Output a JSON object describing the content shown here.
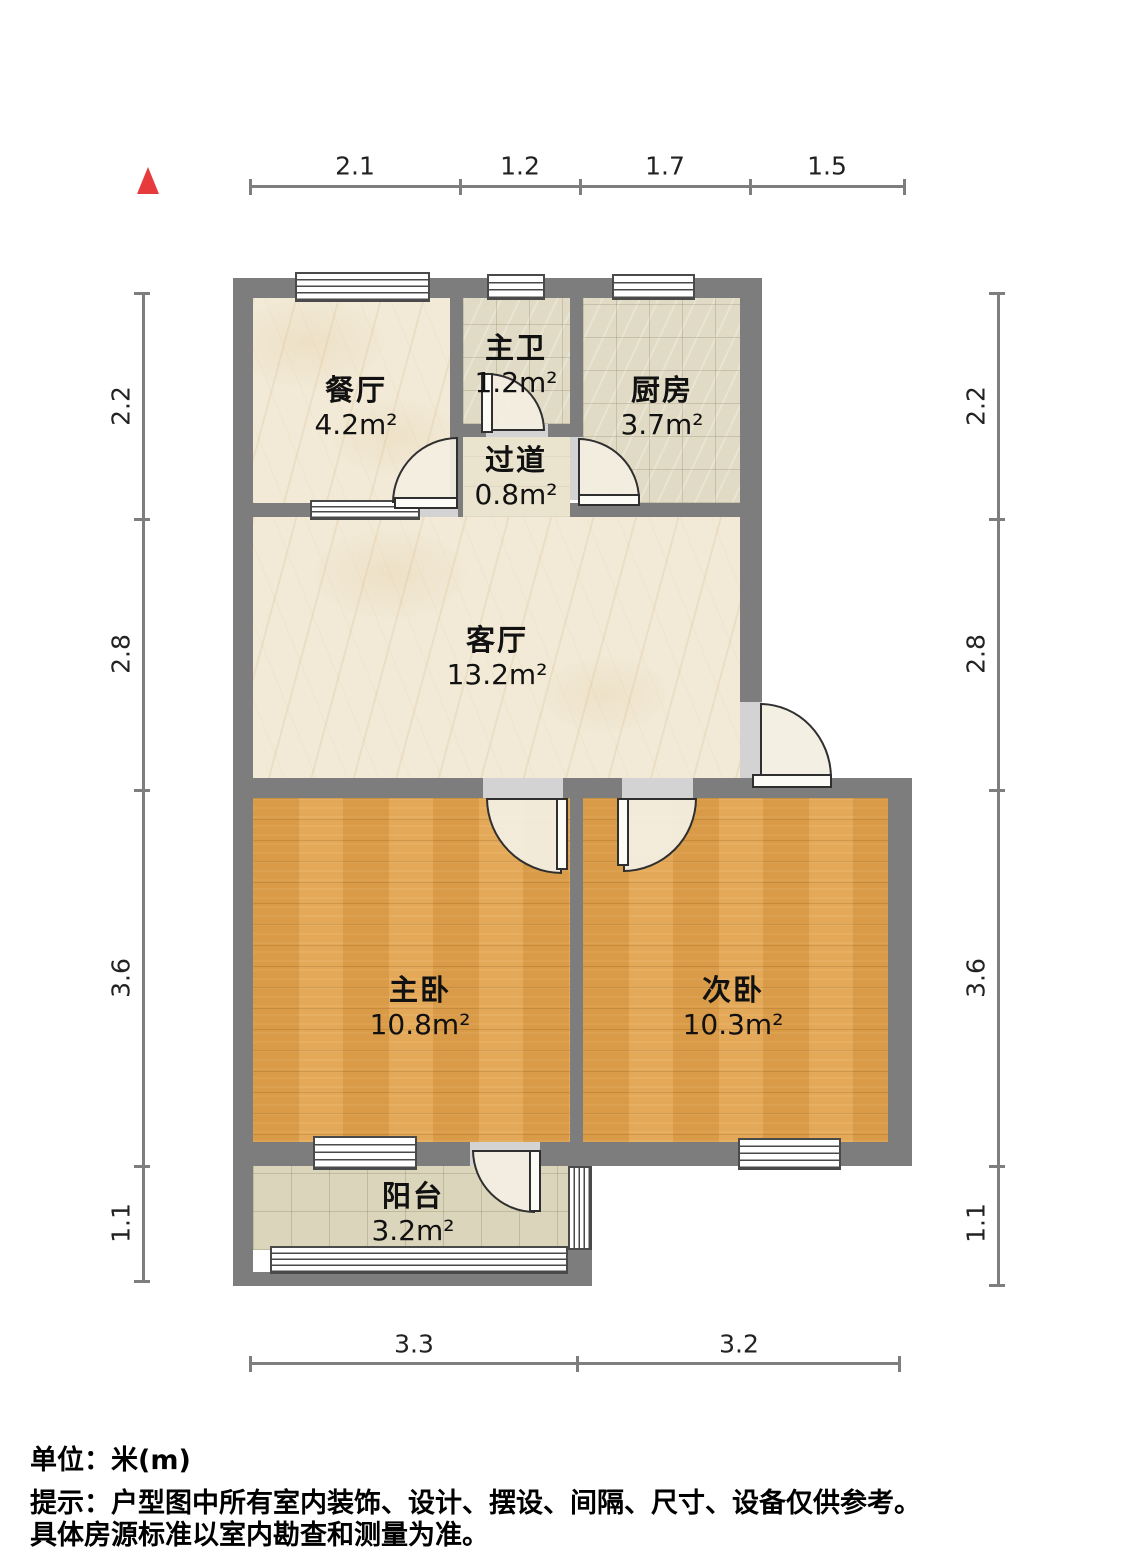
{
  "rooms": [
    {
      "name": "餐厅",
      "area": "4.2m²"
    },
    {
      "name": "主卫",
      "area": "1.2m²"
    },
    {
      "name": "厨房",
      "area": "3.7m²"
    },
    {
      "name": "过道",
      "area": "0.8m²"
    },
    {
      "name": "客厅",
      "area": "13.2m²"
    },
    {
      "name": "主卧",
      "area": "10.8m²"
    },
    {
      "name": "次卧",
      "area": "10.3m²"
    },
    {
      "name": "阳台",
      "area": "3.2m²"
    }
  ],
  "dimensions": {
    "top": [
      "2.1",
      "1.2",
      "1.7",
      "1.5"
    ],
    "bottom": [
      "3.3",
      "3.2"
    ],
    "left": [
      "2.2",
      "2.8",
      "3.6",
      "1.1"
    ],
    "right": [
      "2.2",
      "2.8",
      "3.6",
      "1.1"
    ]
  },
  "footer": {
    "unit": "单位：米(m)",
    "disclaimer1": "提示：户型图中所有室内装饰、设计、摆设、间隔、尺寸、设备仅供参考。",
    "disclaimer2": "具体房源标准以室内勘查和测量为准。"
  },
  "colors": {
    "wall": "#7d7d7d",
    "compass": "#e63a3c",
    "wood_floor": "#dfa14e",
    "marble_floor": "#f2ead7",
    "tile_floor": "#e1dbc5",
    "balcony_floor": "#dbd5bb"
  }
}
